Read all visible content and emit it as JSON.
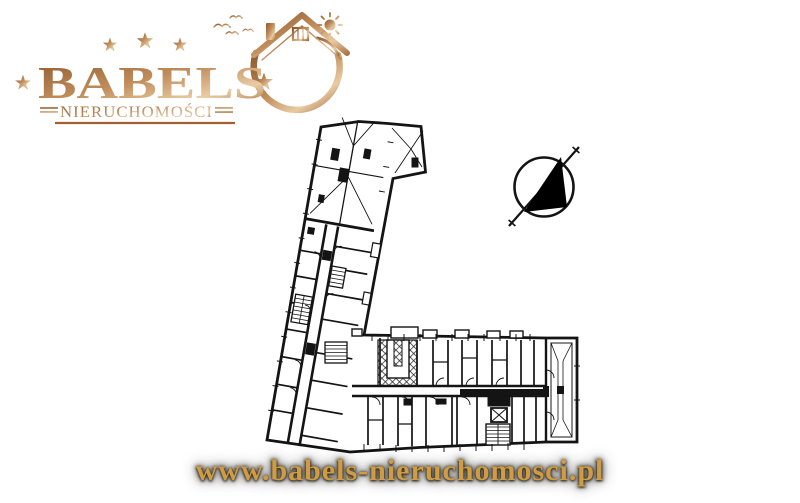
{
  "brand": {
    "name": "BABELS",
    "subtitle": "NIERUCHOMOŚCI",
    "top_star_count": 3,
    "gold_dark": "#8e5a2f",
    "gold_mid": "#c08c5a",
    "gold_light": "#e8cba4",
    "underline_color": "#a35f2e"
  },
  "footer": {
    "url": "www.babels-nieruchomosci.pl",
    "text_color": "#cf9c45"
  },
  "floorplan": {
    "kind": "L-shaped building floor plan",
    "ink_color": "#141414"
  },
  "icons": {
    "north_arrow": "north-arrow-icon",
    "stars": "star-icon",
    "house": "house-roof-icon",
    "sun": "sun-icon",
    "birds": "birds-icon",
    "crescent": "crescent-swoosh-icon"
  }
}
